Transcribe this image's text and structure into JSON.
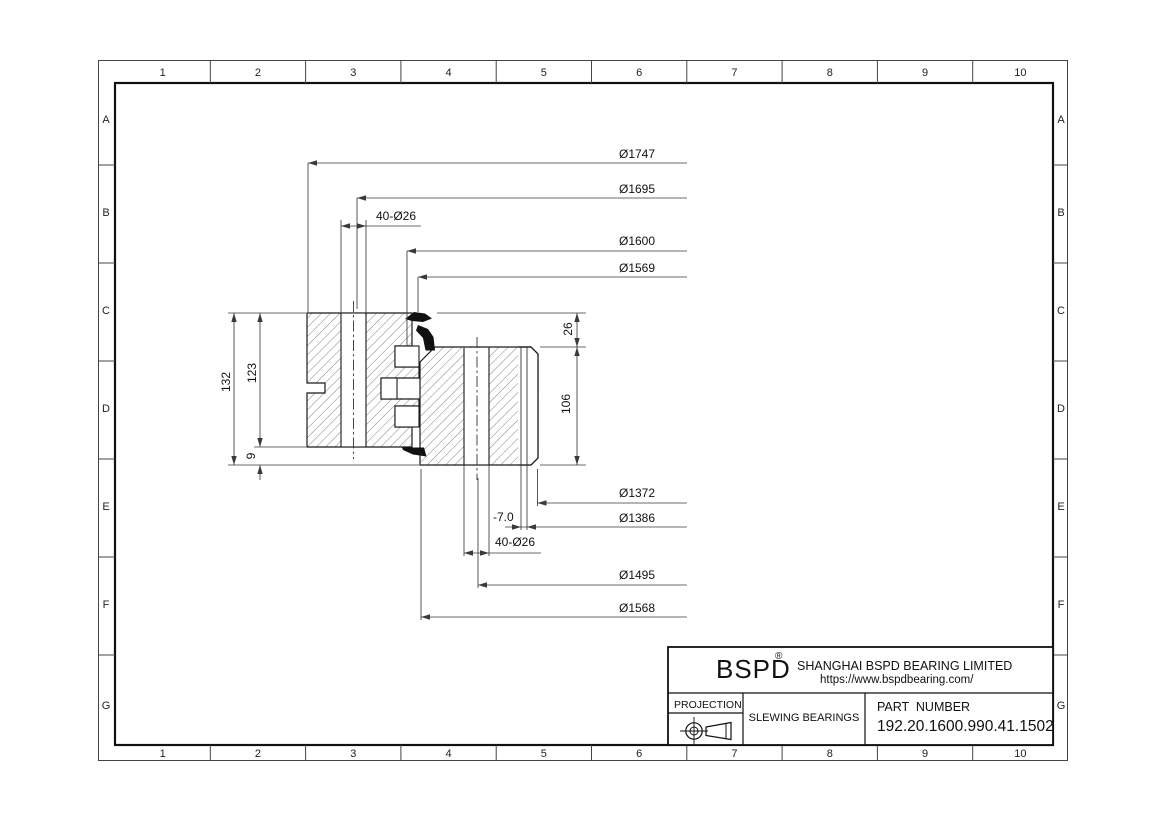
{
  "border": {
    "columns": [
      "1",
      "2",
      "3",
      "4",
      "5",
      "6",
      "7",
      "8",
      "9",
      "10"
    ],
    "rows": [
      "A",
      "B",
      "C",
      "D",
      "E",
      "F",
      "G"
    ]
  },
  "dimensions": {
    "d1747": "Ø1747",
    "d1695": "Ø1695",
    "top_bolts": "40-Ø26",
    "d1600": "Ø1600",
    "d1569": "Ø1569",
    "h26": "26",
    "h106": "106",
    "h132": "132",
    "h123": "123",
    "h9": "9",
    "d1372": "Ø1372",
    "offset": "-7.0",
    "d1386": "Ø1386",
    "bottom_bolts": "40-Ø26",
    "d1495": "Ø1495",
    "d1568": "Ø1568"
  },
  "title_block": {
    "logo": "BSPD",
    "registered": "®",
    "company": "SHANGHAI BSPD BEARING LIMITED",
    "website": "https://www.bspdbearing.com/",
    "projection_label": "PROJECTION",
    "product_type": "SLEWING BEARINGS",
    "part_number_label": "PART  NUMBER",
    "part_number": "192.20.1600.990.41.1502"
  },
  "colors": {
    "line": "#1a1a1a",
    "dim_line": "#3a3a3a",
    "hatch": "#666666",
    "background": "#ffffff"
  }
}
